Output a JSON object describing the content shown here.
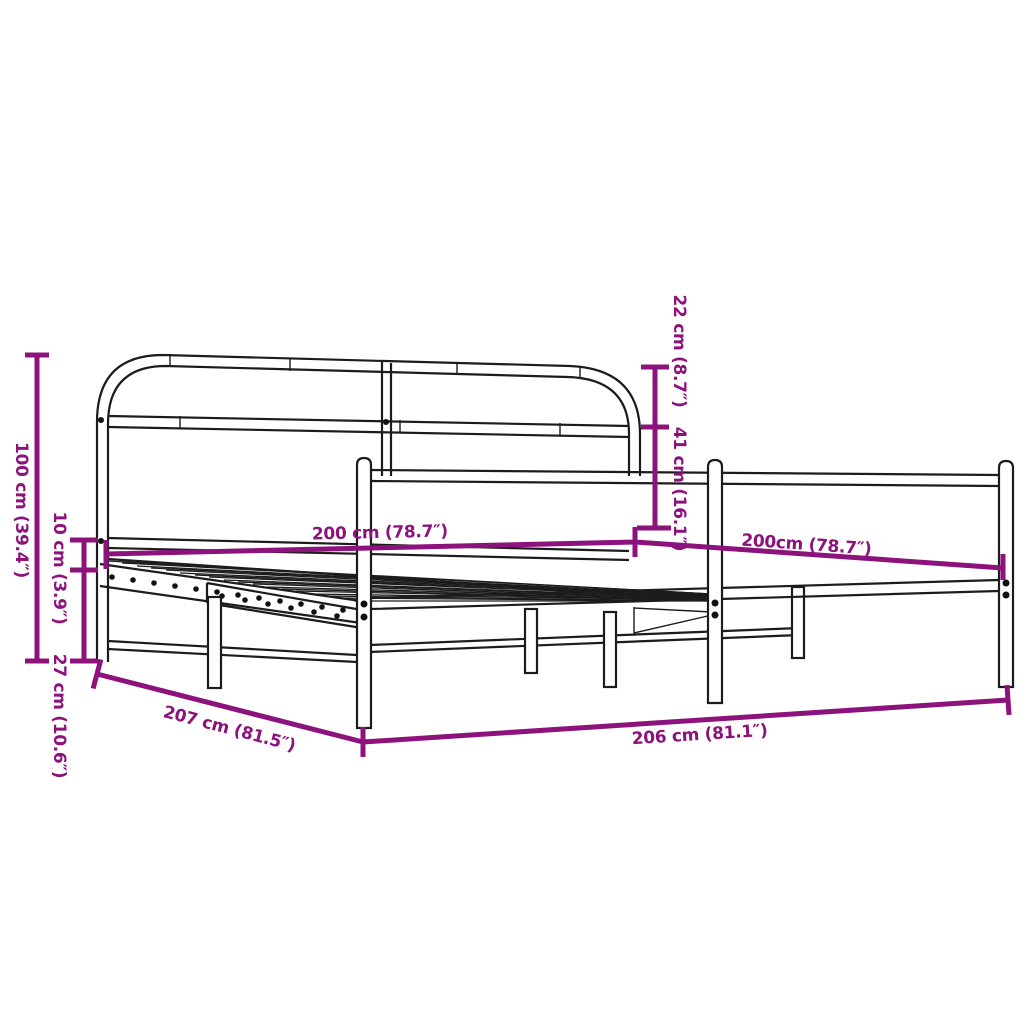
{
  "diagram": {
    "title": "Metal bed frame dimension diagram",
    "background_color": "#ffffff",
    "dimension_color": "#8C127C",
    "outline_color": "#1c1c1c",
    "labels": {
      "headboard_height": "100 cm (39.4″)",
      "frame_top_to_slats": "10 cm (3.9″)",
      "under_bed_clearance": "27 cm (10.6″)",
      "top_rail_gap": "22 cm (8.7″)",
      "headboard_to_base": "41 cm (16.1″)",
      "mattress_length": "200 cm (78.7″)",
      "mattress_width": "200cm (78.7″)",
      "outer_length": "207 cm (81.5″)",
      "outer_width": "206 cm (81.1″)"
    }
  }
}
